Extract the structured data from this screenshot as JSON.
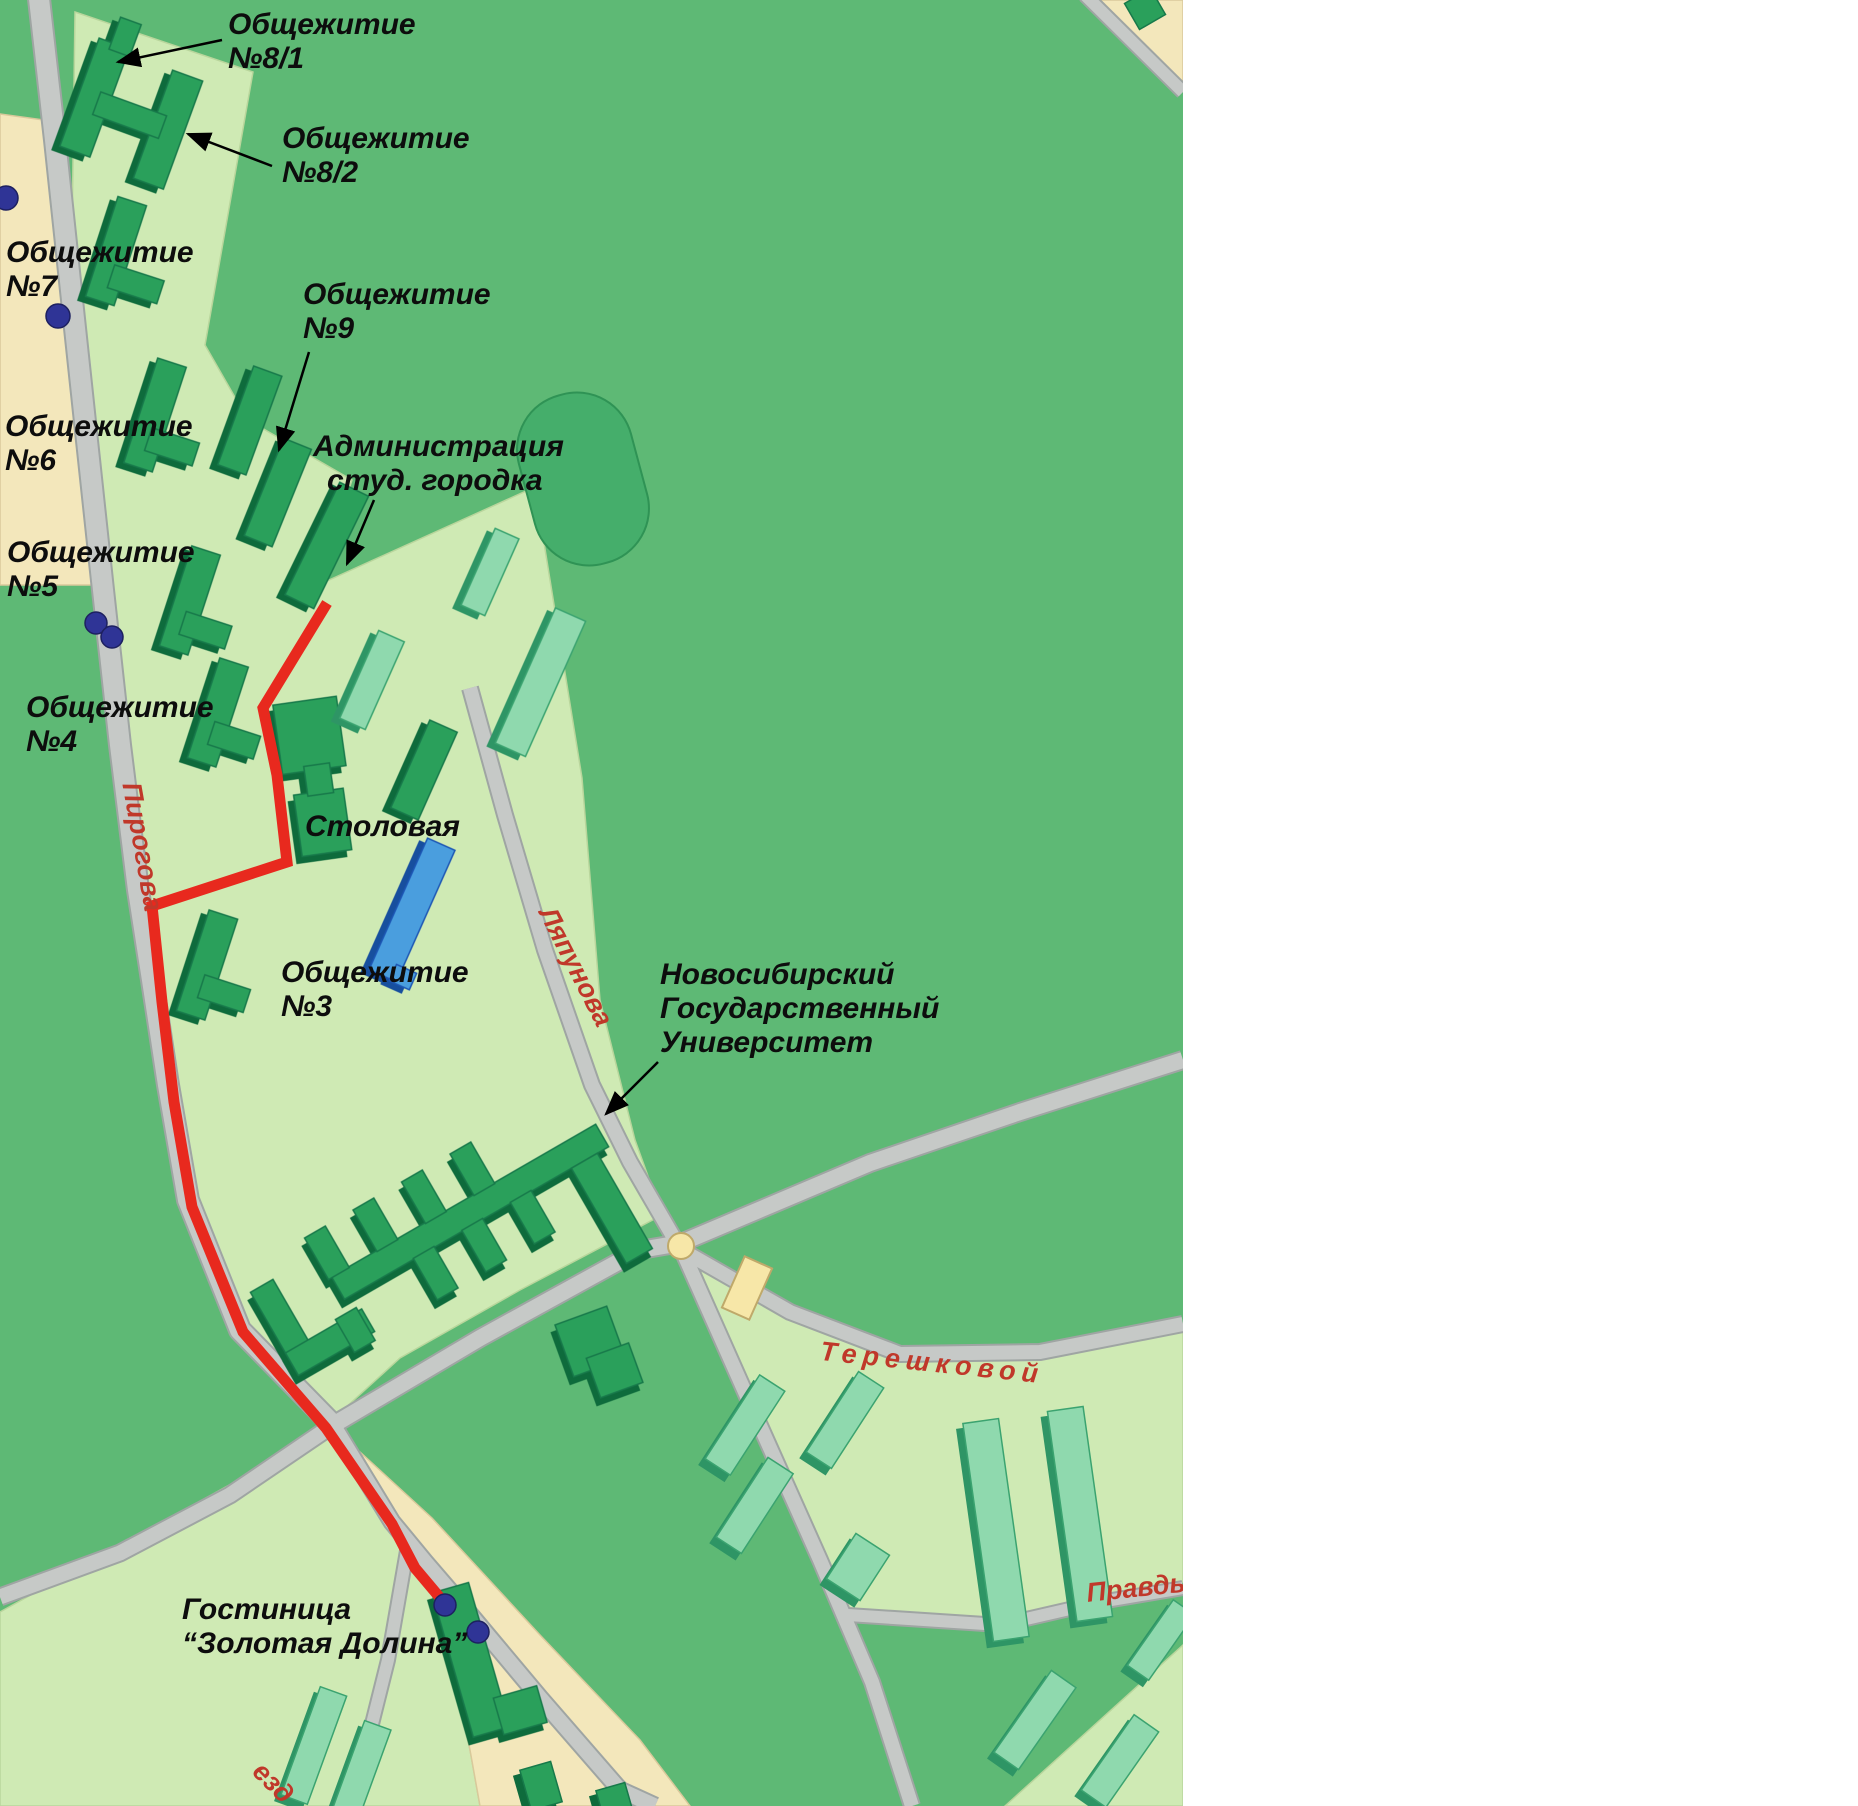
{
  "colors": {
    "background_green": "#5eb975",
    "campus_light_green": "#cfeab4",
    "building_dark_green": "#2aa05b",
    "building_light_green": "#8fd9ae",
    "building_blue": "#4a9ede",
    "road_gray": "#c6c9c7",
    "sand_tan": "#f3e7bb",
    "route_red": "#e8291e",
    "street_label_red": "#c0382a",
    "bus_stop_blue": "#2f3496",
    "text_black": "#0d0d0d"
  },
  "map": {
    "labels": {
      "dorm_8_1": {
        "line1": "Общежитие",
        "line2": "№8/1"
      },
      "dorm_8_2": {
        "line1": "Общежитие",
        "line2": "№8/2"
      },
      "dorm_7": {
        "line1": "Общежитие",
        "line2": "№7"
      },
      "dorm_9": {
        "line1": "Общежитие",
        "line2": "№9"
      },
      "dorm_6": {
        "line1": "Общежитие",
        "line2": "№6"
      },
      "admin": {
        "line1": "Администрация",
        "line2": "студ. городка"
      },
      "dorm_5": {
        "line1": "Общежитие",
        "line2": "№5"
      },
      "dorm_4": {
        "line1": "Общежитие",
        "line2": "№4"
      },
      "stolovaya": {
        "line1": "Столовая"
      },
      "dorm_3": {
        "line1": "Общежитие",
        "line2": "№3"
      },
      "nsu": {
        "line1": "Новосибирский",
        "line2": "Государственный",
        "line3": "Университет"
      },
      "hotel": {
        "line1": "Гостиница",
        "line2": "“Золотая Долина”"
      }
    },
    "streets": {
      "pirogova": "Пирогова",
      "lyapunova": "Ляпунова",
      "tereshkovoy": "Терешковой",
      "pravdy": "Правды",
      "proezd": "езд"
    }
  },
  "panel": {
    "title": "Адреса",
    "entries": [
      {
        "name": "Администрация студ. Городка (общ. №10)",
        "address": "Пирогова, 10"
      },
      {
        "name": "Гостиница “Золотая долина”",
        "address": "Ильича, 10"
      },
      {
        "name": "Общежитие №3",
        "address": "Пирогова, 4"
      },
      {
        "name": "Общежитие №4",
        "address": "Пирогова, 8"
      },
      {
        "name": "Общежитие №5",
        "address": "Пирогова, 14"
      },
      {
        "name": "Общежитие №6",
        "address": "Пирогова, 16"
      },
      {
        "name": "Общежитие №7",
        "address": "Пирогова, 18"
      },
      {
        "name": "Общежитие №8/1",
        "address": "Пирогова, 20/1"
      },
      {
        "name": "Общежитие №8/2",
        "address": "Пирогова, 20/2"
      },
      {
        "name": "Общежитие №9",
        "address": "Пирогова, 18а"
      }
    ]
  }
}
